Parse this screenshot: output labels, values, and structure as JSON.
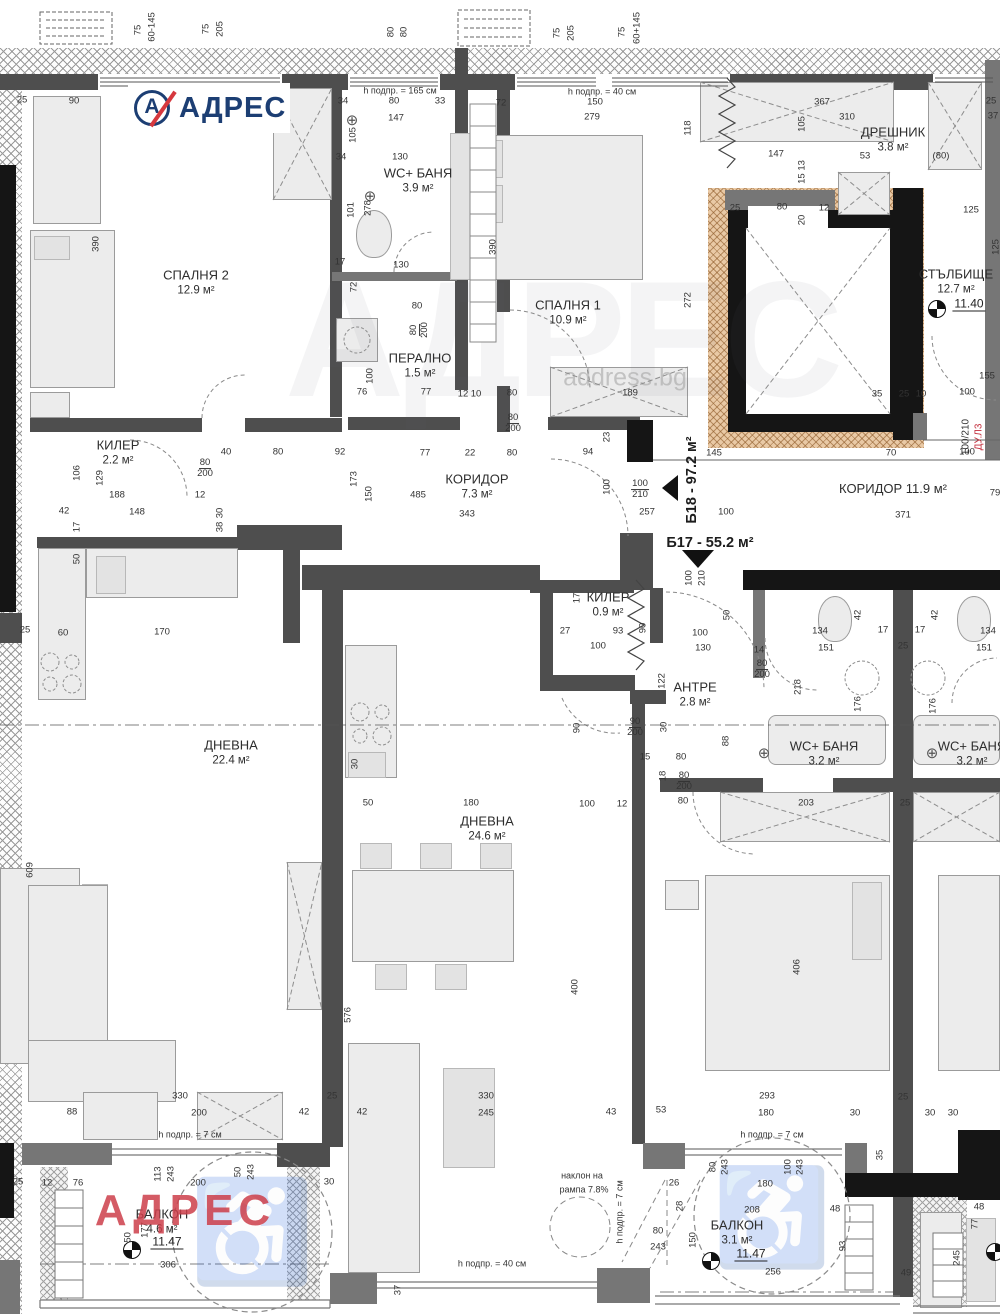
{
  "logo": {
    "text": "АДРЕС",
    "mark_letter": "А"
  },
  "watermarks": {
    "big": "АДРЕС",
    "site": "address.bg",
    "red": "АДРЕС"
  },
  "icons": {
    "drain_glyph": "⊕",
    "wheelchair_glyph": "♿"
  },
  "colors": {
    "accent_blue": "#1c3e73",
    "accent_red": "#d6383e",
    "wall_gray": "#4e4e4e",
    "black": "#151515",
    "elevator_tan": "#e9c9a5",
    "red_note": "#c32b3a"
  },
  "units": [
    {
      "text": "Б17 - 55.2 м²"
    },
    {
      "text": "Б18 - 97.2 м²"
    }
  ],
  "door_tag": {
    "size": "100/210",
    "code": "ДУ.Л3"
  },
  "levels": [
    {
      "v": "11.40",
      "x": 969,
      "y": 304,
      "sx": 937,
      "sy": 309
    },
    {
      "v": "11.47",
      "x": 167,
      "y": 1242,
      "sx": 132,
      "sy": 1250
    },
    {
      "v": "11.47",
      "x": 751,
      "y": 1254,
      "sx": 711,
      "sy": 1261
    },
    {
      "v": "",
      "x": -100,
      "y": -100,
      "sx": 995,
      "sy": 1252
    }
  ],
  "rooms": [
    {
      "label": "СПАЛНЯ 2",
      "area": "12.9 м²",
      "x": 196,
      "y": 283
    },
    {
      "label": "WC+ БАНЯ",
      "area": "3.9 м²",
      "x": 418,
      "y": 181
    },
    {
      "label": "ПЕРАЛНО",
      "area": "1.5 м²",
      "x": 420,
      "y": 366
    },
    {
      "label": "СПАЛНЯ 1",
      "area": "10.9 м²",
      "x": 568,
      "y": 313
    },
    {
      "label": "ДРЕШНИК",
      "area": "3.8 м²",
      "x": 893,
      "y": 140
    },
    {
      "label": "СТЪЛБИЩЕ",
      "area": "12.7 м²",
      "x": 956,
      "y": 282
    },
    {
      "label": "КИЛЕР",
      "area": "2.2 м²",
      "x": 118,
      "y": 453
    },
    {
      "label": "КОРИДОР",
      "area": "7.3 м²",
      "x": 477,
      "y": 487
    },
    {
      "label": "КОРИДОР 11.9 м²",
      "area": "",
      "x": 893,
      "y": 489
    },
    {
      "label": "КИЛЕР",
      "area": "0.9 м²",
      "x": 608,
      "y": 605
    },
    {
      "label": "АНТРЕ",
      "area": "2.8 м²",
      "x": 695,
      "y": 695
    },
    {
      "label": "WC+ БАНЯ",
      "area": "3.2 м²",
      "x": 824,
      "y": 754
    },
    {
      "label": "WC+ БАНЯ",
      "area": "3.2 м²",
      "x": 972,
      "y": 754
    },
    {
      "label": "ДНЕВНА",
      "area": "22.4 м²",
      "x": 231,
      "y": 753
    },
    {
      "label": "ДНЕВНА",
      "area": "24.6 м²",
      "x": 487,
      "y": 829
    },
    {
      "label": "БАЛКОН",
      "area": "4.6 м²",
      "x": 162,
      "y": 1222
    },
    {
      "label": "БАЛКОН",
      "area": "3.1 м²",
      "x": 737,
      "y": 1233
    }
  ],
  "dimensions": [
    {
      "t": "75",
      "x": 138,
      "y": 30,
      "v": 1
    },
    {
      "t": "60-145",
      "x": 152,
      "y": 27,
      "v": 1
    },
    {
      "t": "75",
      "x": 206,
      "y": 29,
      "v": 1
    },
    {
      "t": "205",
      "x": 220,
      "y": 29,
      "v": 1
    },
    {
      "t": "80",
      "x": 391,
      "y": 32,
      "v": 1
    },
    {
      "t": "80",
      "x": 404,
      "y": 32,
      "v": 1
    },
    {
      "t": "75",
      "x": 557,
      "y": 33,
      "v": 1
    },
    {
      "t": "205",
      "x": 571,
      "y": 33,
      "v": 1
    },
    {
      "t": "75",
      "x": 622,
      "y": 32,
      "v": 1
    },
    {
      "t": "60+145",
      "x": 637,
      "y": 28,
      "v": 1
    },
    {
      "t": "25",
      "x": 22,
      "y": 100
    },
    {
      "t": "90",
      "x": 74,
      "y": 101
    },
    {
      "t": "90",
      "x": 278,
      "y": 100
    },
    {
      "t": "h подпр. = 165 см",
      "x": 400,
      "y": 91,
      "s": 9
    },
    {
      "t": "34",
      "x": 343,
      "y": 101
    },
    {
      "t": "80",
      "x": 394,
      "y": 101
    },
    {
      "t": "33",
      "x": 440,
      "y": 101
    },
    {
      "t": "147",
      "x": 396,
      "y": 118
    },
    {
      "t": "105",
      "x": 353,
      "y": 135,
      "v": 1
    },
    {
      "t": "h подпр. = 40 см",
      "x": 602,
      "y": 92,
      "s": 9
    },
    {
      "t": "72",
      "x": 501,
      "y": 103
    },
    {
      "t": "150",
      "x": 595,
      "y": 102
    },
    {
      "t": "279",
      "x": 592,
      "y": 117
    },
    {
      "t": "118",
      "x": 688,
      "y": 128,
      "v": 1
    },
    {
      "t": "367",
      "x": 822,
      "y": 102
    },
    {
      "t": "310",
      "x": 847,
      "y": 117
    },
    {
      "t": "105",
      "x": 802,
      "y": 124,
      "v": 1
    },
    {
      "t": "147",
      "x": 776,
      "y": 154
    },
    {
      "t": "53",
      "x": 865,
      "y": 156
    },
    {
      "t": "(80)",
      "x": 941,
      "y": 156
    },
    {
      "t": "25",
      "x": 991,
      "y": 101
    },
    {
      "t": "37",
      "x": 993,
      "y": 116
    },
    {
      "t": "130",
      "x": 400,
      "y": 157
    },
    {
      "t": "34",
      "x": 341,
      "y": 157
    },
    {
      "t": "101",
      "x": 351,
      "y": 210,
      "v": 1
    },
    {
      "t": "278",
      "x": 368,
      "y": 208,
      "v": 1
    },
    {
      "t": "130",
      "x": 401,
      "y": 265
    },
    {
      "t": "17",
      "x": 340,
      "y": 262
    },
    {
      "t": "72",
      "x": 354,
      "y": 287,
      "v": 1
    },
    {
      "t": "80",
      "x": 417,
      "y": 306
    },
    {
      "t": "390",
      "x": 96,
      "y": 244,
      "v": 1
    },
    {
      "t": "390",
      "x": 493,
      "y": 247,
      "v": 1
    },
    {
      "t": "272",
      "x": 688,
      "y": 300,
      "v": 1
    },
    {
      "t": "15 13",
      "x": 802,
      "y": 172,
      "v": 1
    },
    {
      "t": "25",
      "x": 735,
      "y": 208
    },
    {
      "t": "80",
      "x": 782,
      "y": 207
    },
    {
      "t": "12",
      "x": 824,
      "y": 208
    },
    {
      "t": "20",
      "x": 802,
      "y": 220,
      "v": 1
    },
    {
      "t": "125",
      "x": 971,
      "y": 210
    },
    {
      "t": "125",
      "x": 996,
      "y": 247,
      "v": 1
    },
    {
      "t": "155",
      "x": 987,
      "y": 376
    },
    {
      "t": "35",
      "x": 877,
      "y": 394
    },
    {
      "t": "25",
      "x": 904,
      "y": 394
    },
    {
      "t": "10",
      "x": 921,
      "y": 394
    },
    {
      "t": "100",
      "x": 967,
      "y": 392
    },
    {
      "t": "189",
      "x": 630,
      "y": 393
    },
    {
      "t": "76",
      "x": 362,
      "y": 392
    },
    {
      "t": "77",
      "x": 426,
      "y": 392
    },
    {
      "t": "12",
      "x": 463,
      "y": 394
    },
    {
      "t": "10",
      "x": 476,
      "y": 394
    },
    {
      "t": "80",
      "x": 512,
      "y": 393
    },
    {
      "t": "80/200",
      "x": 513,
      "y": 424,
      "f": 1
    },
    {
      "t": "100",
      "x": 370,
      "y": 376,
      "v": 1
    },
    {
      "t": "80/200",
      "x": 420,
      "y": 330,
      "f": 1,
      "v": 1
    },
    {
      "t": "23",
      "x": 607,
      "y": 437,
      "v": 1
    },
    {
      "t": "40",
      "x": 226,
      "y": 452
    },
    {
      "t": "80",
      "x": 278,
      "y": 452
    },
    {
      "t": "92",
      "x": 340,
      "y": 452
    },
    {
      "t": "77",
      "x": 425,
      "y": 453
    },
    {
      "t": "22",
      "x": 470,
      "y": 453
    },
    {
      "t": "80",
      "x": 512,
      "y": 453
    },
    {
      "t": "94",
      "x": 588,
      "y": 452
    },
    {
      "t": "145",
      "x": 714,
      "y": 453
    },
    {
      "t": "70",
      "x": 891,
      "y": 453
    },
    {
      "t": "100",
      "x": 967,
      "y": 452
    },
    {
      "t": "80/200",
      "x": 205,
      "y": 469,
      "f": 1
    },
    {
      "t": "173",
      "x": 354,
      "y": 479,
      "v": 1
    },
    {
      "t": "150",
      "x": 369,
      "y": 494,
      "v": 1
    },
    {
      "t": "485",
      "x": 418,
      "y": 495
    },
    {
      "t": "343",
      "x": 467,
      "y": 514
    },
    {
      "t": "100",
      "x": 607,
      "y": 487,
      "v": 1
    },
    {
      "t": "100/210",
      "x": 640,
      "y": 490,
      "f": 1
    },
    {
      "t": "257",
      "x": 647,
      "y": 512
    },
    {
      "t": "100",
      "x": 726,
      "y": 512
    },
    {
      "t": "371",
      "x": 903,
      "y": 515
    },
    {
      "t": "79",
      "x": 995,
      "y": 493
    },
    {
      "t": "106",
      "x": 77,
      "y": 473,
      "v": 1
    },
    {
      "t": "129",
      "x": 100,
      "y": 478,
      "v": 1
    },
    {
      "t": "188",
      "x": 117,
      "y": 495
    },
    {
      "t": "42",
      "x": 64,
      "y": 511
    },
    {
      "t": "148",
      "x": 137,
      "y": 512
    },
    {
      "t": "12",
      "x": 200,
      "y": 495
    },
    {
      "t": "30",
      "x": 220,
      "y": 513,
      "v": 1
    },
    {
      "t": "38",
      "x": 220,
      "y": 527,
      "v": 1
    },
    {
      "t": "17",
      "x": 77,
      "y": 527,
      "v": 1
    },
    {
      "t": "50",
      "x": 77,
      "y": 559,
      "v": 1
    },
    {
      "t": "25",
      "x": 25,
      "y": 630
    },
    {
      "t": "60",
      "x": 63,
      "y": 633
    },
    {
      "t": "170",
      "x": 162,
      "y": 632
    },
    {
      "t": "17",
      "x": 577,
      "y": 598,
      "v": 1
    },
    {
      "t": "27",
      "x": 565,
      "y": 631
    },
    {
      "t": "93",
      "x": 618,
      "y": 631
    },
    {
      "t": "100",
      "x": 598,
      "y": 646
    },
    {
      "t": "90",
      "x": 643,
      "y": 628,
      "v": 1
    },
    {
      "t": "122",
      "x": 662,
      "y": 681,
      "v": 1
    },
    {
      "t": "90/200",
      "x": 635,
      "y": 728,
      "f": 1
    },
    {
      "t": "90",
      "x": 577,
      "y": 728,
      "v": 1
    },
    {
      "t": "30",
      "x": 664,
      "y": 727,
      "v": 1
    },
    {
      "t": "100",
      "x": 689,
      "y": 578,
      "v": 1
    },
    {
      "t": "210",
      "x": 702,
      "y": 578,
      "v": 1
    },
    {
      "t": "50",
      "x": 727,
      "y": 615,
      "v": 1
    },
    {
      "t": "100",
      "x": 700,
      "y": 633
    },
    {
      "t": "130",
      "x": 703,
      "y": 648
    },
    {
      "t": "14",
      "x": 759,
      "y": 650
    },
    {
      "t": "80/200",
      "x": 762,
      "y": 670,
      "f": 1
    },
    {
      "t": "218",
      "x": 798,
      "y": 687,
      "v": 1
    },
    {
      "t": "134",
      "x": 820,
      "y": 631
    },
    {
      "t": "151",
      "x": 826,
      "y": 648
    },
    {
      "t": "17",
      "x": 883,
      "y": 630
    },
    {
      "t": "42",
      "x": 858,
      "y": 615,
      "v": 1
    },
    {
      "t": "25",
      "x": 903,
      "y": 646
    },
    {
      "t": "17",
      "x": 920,
      "y": 630
    },
    {
      "t": "42",
      "x": 935,
      "y": 615,
      "v": 1
    },
    {
      "t": "134",
      "x": 988,
      "y": 631
    },
    {
      "t": "151",
      "x": 984,
      "y": 648
    },
    {
      "t": "176",
      "x": 858,
      "y": 704,
      "v": 1
    },
    {
      "t": "176",
      "x": 933,
      "y": 706,
      "v": 1
    },
    {
      "t": "88",
      "x": 726,
      "y": 741,
      "v": 1
    },
    {
      "t": "15",
      "x": 645,
      "y": 757
    },
    {
      "t": "80",
      "x": 681,
      "y": 757
    },
    {
      "t": "18",
      "x": 663,
      "y": 776,
      "v": 1
    },
    {
      "t": "80/200",
      "x": 684,
      "y": 782,
      "f": 1
    },
    {
      "t": "80",
      "x": 683,
      "y": 801
    },
    {
      "t": "100",
      "x": 587,
      "y": 804
    },
    {
      "t": "12",
      "x": 622,
      "y": 804
    },
    {
      "t": "203",
      "x": 806,
      "y": 803
    },
    {
      "t": "25",
      "x": 905,
      "y": 803
    },
    {
      "t": "406",
      "x": 797,
      "y": 967,
      "v": 1
    },
    {
      "t": "400",
      "x": 575,
      "y": 987,
      "v": 1
    },
    {
      "t": "50",
      "x": 368,
      "y": 803
    },
    {
      "t": "180",
      "x": 471,
      "y": 803
    },
    {
      "t": "30",
      "x": 355,
      "y": 764,
      "v": 1
    },
    {
      "t": "609",
      "x": 30,
      "y": 870,
      "v": 1
    },
    {
      "t": "576",
      "x": 348,
      "y": 1015,
      "v": 1
    },
    {
      "t": "330",
      "x": 180,
      "y": 1096
    },
    {
      "t": "200",
      "x": 199,
      "y": 1113
    },
    {
      "t": "88",
      "x": 72,
      "y": 1112
    },
    {
      "t": "h подпр. = 7 см",
      "x": 190,
      "y": 1135,
      "s": 9
    },
    {
      "t": "42",
      "x": 304,
      "y": 1112
    },
    {
      "t": "25",
      "x": 332,
      "y": 1096
    },
    {
      "t": "42",
      "x": 362,
      "y": 1112
    },
    {
      "t": "330",
      "x": 486,
      "y": 1096
    },
    {
      "t": "245",
      "x": 486,
      "y": 1113
    },
    {
      "t": "43",
      "x": 611,
      "y": 1112
    },
    {
      "t": "53",
      "x": 661,
      "y": 1110
    },
    {
      "t": "293",
      "x": 767,
      "y": 1096
    },
    {
      "t": "180",
      "x": 766,
      "y": 1113
    },
    {
      "t": "30",
      "x": 855,
      "y": 1113
    },
    {
      "t": "30",
      "x": 930,
      "y": 1113
    },
    {
      "t": "30",
      "x": 953,
      "y": 1113
    },
    {
      "t": "25",
      "x": 903,
      "y": 1097
    },
    {
      "t": "h подпр. = 7 см",
      "x": 772,
      "y": 1135,
      "s": 9
    },
    {
      "t": "25",
      "x": 18,
      "y": 1182
    },
    {
      "t": "12",
      "x": 47,
      "y": 1183
    },
    {
      "t": "76",
      "x": 78,
      "y": 1183
    },
    {
      "t": "113",
      "x": 158,
      "y": 1174,
      "v": 1
    },
    {
      "t": "243",
      "x": 171,
      "y": 1174,
      "v": 1
    },
    {
      "t": "200",
      "x": 198,
      "y": 1183
    },
    {
      "t": "50",
      "x": 238,
      "y": 1172,
      "v": 1
    },
    {
      "t": "243",
      "x": 251,
      "y": 1172,
      "v": 1
    },
    {
      "t": "30",
      "x": 329,
      "y": 1182
    },
    {
      "t": "177",
      "x": 145,
      "y": 1230,
      "v": 1
    },
    {
      "t": "150",
      "x": 128,
      "y": 1240,
      "v": 1
    },
    {
      "t": "306",
      "x": 168,
      "y": 1265
    },
    {
      "t": "37",
      "x": 398,
      "y": 1290,
      "v": 1
    },
    {
      "t": "наклон на",
      "x": 582,
      "y": 1176,
      "s": 9
    },
    {
      "t": "рампа 7.8%",
      "x": 584,
      "y": 1190,
      "s": 9
    },
    {
      "t": "h подпр. = 7 см",
      "x": 620,
      "y": 1212,
      "v": 1,
      "s": 9
    },
    {
      "t": "80",
      "x": 658,
      "y": 1231
    },
    {
      "t": "243",
      "x": 658,
      "y": 1247
    },
    {
      "t": "h подпр. = 40 см",
      "x": 492,
      "y": 1264,
      "s": 9
    },
    {
      "t": "26",
      "x": 674,
      "y": 1183
    },
    {
      "t": "28",
      "x": 680,
      "y": 1206,
      "v": 1
    },
    {
      "t": "80",
      "x": 713,
      "y": 1167,
      "v": 1
    },
    {
      "t": "243",
      "x": 725,
      "y": 1167,
      "v": 1
    },
    {
      "t": "100",
      "x": 788,
      "y": 1167,
      "v": 1
    },
    {
      "t": "243",
      "x": 800,
      "y": 1167,
      "v": 1
    },
    {
      "t": "180",
      "x": 765,
      "y": 1184
    },
    {
      "t": "208",
      "x": 752,
      "y": 1210
    },
    {
      "t": "48",
      "x": 835,
      "y": 1209
    },
    {
      "t": "35",
      "x": 880,
      "y": 1155,
      "v": 1
    },
    {
      "t": "93",
      "x": 843,
      "y": 1246,
      "v": 1
    },
    {
      "t": "150",
      "x": 693,
      "y": 1240,
      "v": 1
    },
    {
      "t": "256",
      "x": 773,
      "y": 1272
    },
    {
      "t": "49",
      "x": 906,
      "y": 1273
    },
    {
      "t": "245",
      "x": 957,
      "y": 1258,
      "v": 1
    },
    {
      "t": "77",
      "x": 975,
      "y": 1224,
      "v": 1
    },
    {
      "t": "48",
      "x": 979,
      "y": 1207
    }
  ]
}
